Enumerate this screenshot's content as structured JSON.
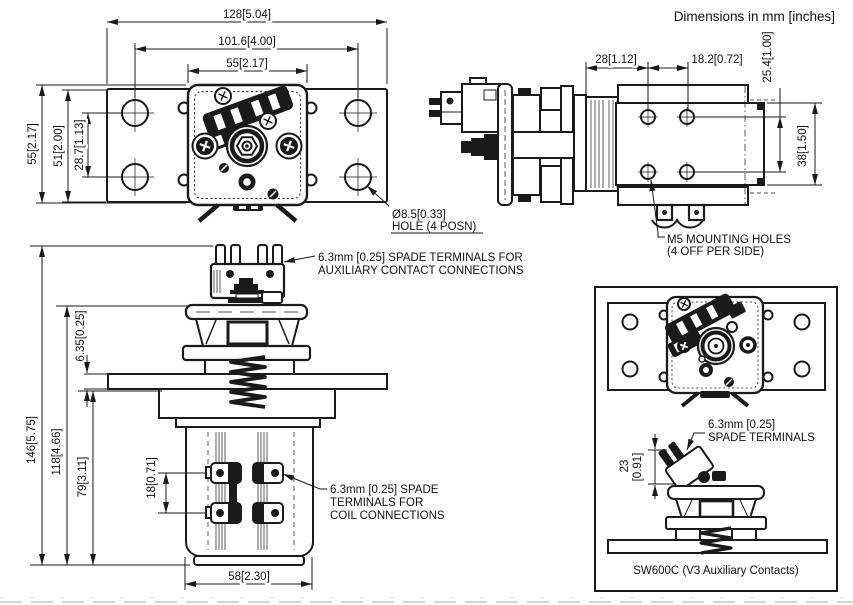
{
  "title": "Dimensions in mm [inches]",
  "colors": {
    "line": "#1a1a1a",
    "background": "#ffffff"
  },
  "views": {
    "top": {
      "dims": {
        "overall_width": "128[5.04]",
        "mount_hole_spacing_x": "101.6[4.00]",
        "body_width": "55[2.17]",
        "body_depth": "55[2.17]",
        "bracket_depth": "51[2.00]",
        "mount_hole_spacing_y": "28.7[1.13]"
      },
      "hole_callout": {
        "line1": "Ø8.5[0.33]",
        "line2": "HOLE (4 POSN)"
      }
    },
    "side": {
      "dims": {
        "flange_to_hole": "28[1.12]",
        "hole_spacing_x": "18.2[0.72]",
        "hole_spacing_y": "25.4[1.00]",
        "bracket_height": "38[1.50]"
      },
      "m5_callout": {
        "line1": "M5 MOUNTING HOLES",
        "line2": "(4 OFF PER SIDE)"
      }
    },
    "front": {
      "dims": {
        "overall_height": "146[5.75]",
        "height_to_top_bar": "118[4.66]",
        "height_to_flange": "79[3.11]",
        "flange_thickness": "6.35[0.25]",
        "coil_terminal_spacing": "18[0.71]",
        "body_width": "58[2.30]"
      },
      "aux_callout": {
        "line1": "6.3mm [0.25] SPADE TERMINALS FOR",
        "line2": "AUXILIARY CONTACT CONNECTIONS"
      },
      "coil_callout": {
        "line1": "6.3mm [0.25] SPADE",
        "line2": "TERMINALS FOR",
        "line3": "COIL CONNECTIONS"
      }
    },
    "inset": {
      "spade_callout": {
        "line1": "6.3mm [0.25]",
        "line2": "SPADE TERMINALS"
      },
      "dims": {
        "aux_height_mm": "23",
        "aux_height_in": "[0.91]"
      },
      "caption": "SW600C (V3 Auxiliary Contacts)"
    }
  }
}
